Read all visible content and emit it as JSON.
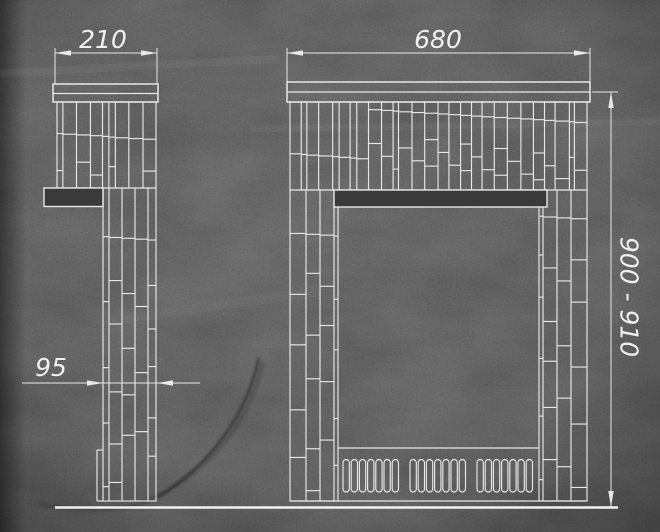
{
  "drawing": {
    "title": "Fireplace portal tiling drawing, front and side views",
    "background_color": "#3a3a3a",
    "line_color": "#e8e8e8",
    "text_color": "#f0f0f0",
    "views": {
      "side": {
        "width_label": "210",
        "pier_depth_label": "95"
      },
      "front": {
        "width_label": "680",
        "height_label": "900 - 910"
      }
    },
    "grille": {
      "groups": 3,
      "slots_per_group": 7
    }
  }
}
